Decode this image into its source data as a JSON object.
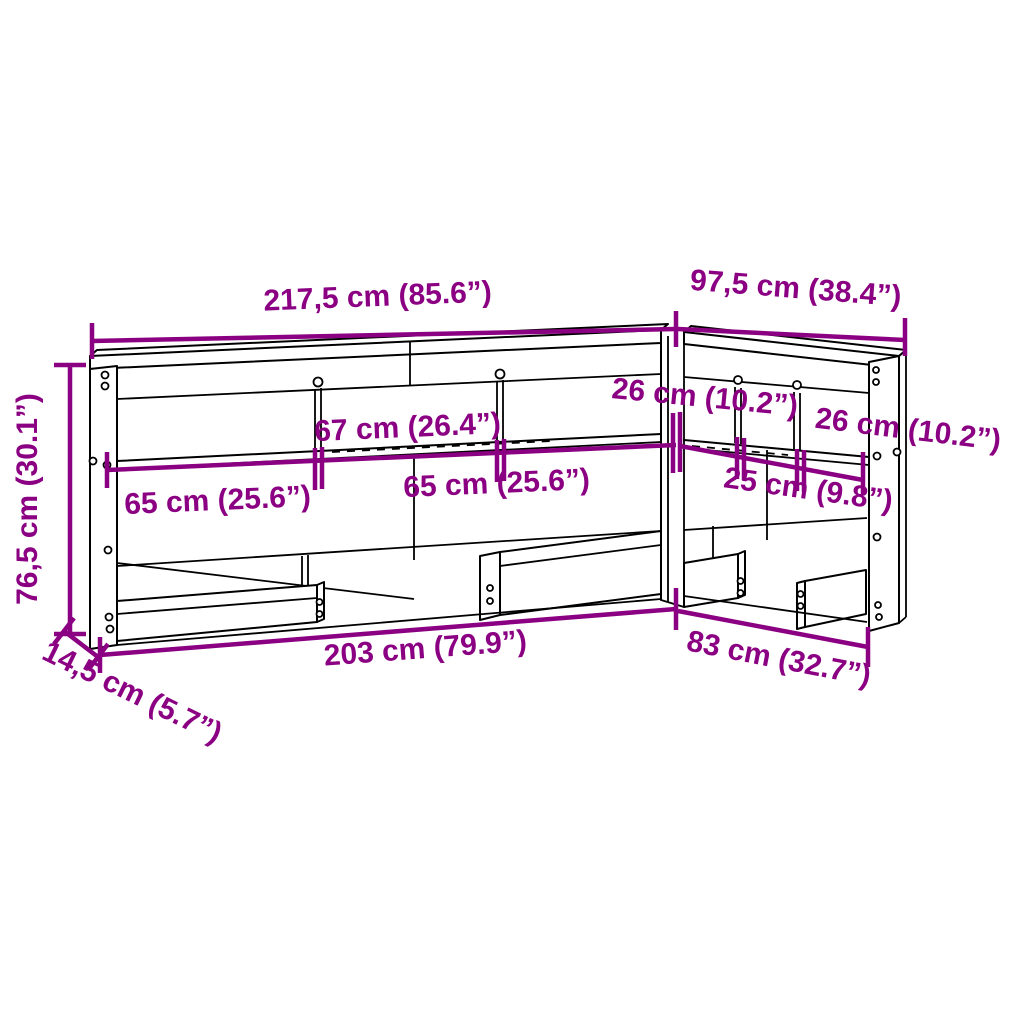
{
  "diagram": {
    "type": "furniture-dimension-drawing",
    "product": "l-shaped-bookcase-headboard",
    "colors": {
      "accent": "#8B0082",
      "line": "#000000",
      "background": "#FFFFFF"
    },
    "dimensions": {
      "front_width": "217,5 cm (85.6”)",
      "return_width": "97,5 cm (38.4”)",
      "height": "76,5 cm (30.1”)",
      "depth": "14,5 cm (5.7”)",
      "shelf_front_left": "65 cm (25.6”)",
      "shelf_front_center": "67 cm (26.4”)",
      "shelf_front_right": "65 cm (25.6”)",
      "shelf_return_first": "26 cm (10.2”)",
      "shelf_return_middle": "25 cm (9.8”)",
      "shelf_return_last": "26 cm (10.2”)",
      "base_front": "203 cm (79.9”)",
      "base_return": "83 cm (32.7”)"
    }
  }
}
